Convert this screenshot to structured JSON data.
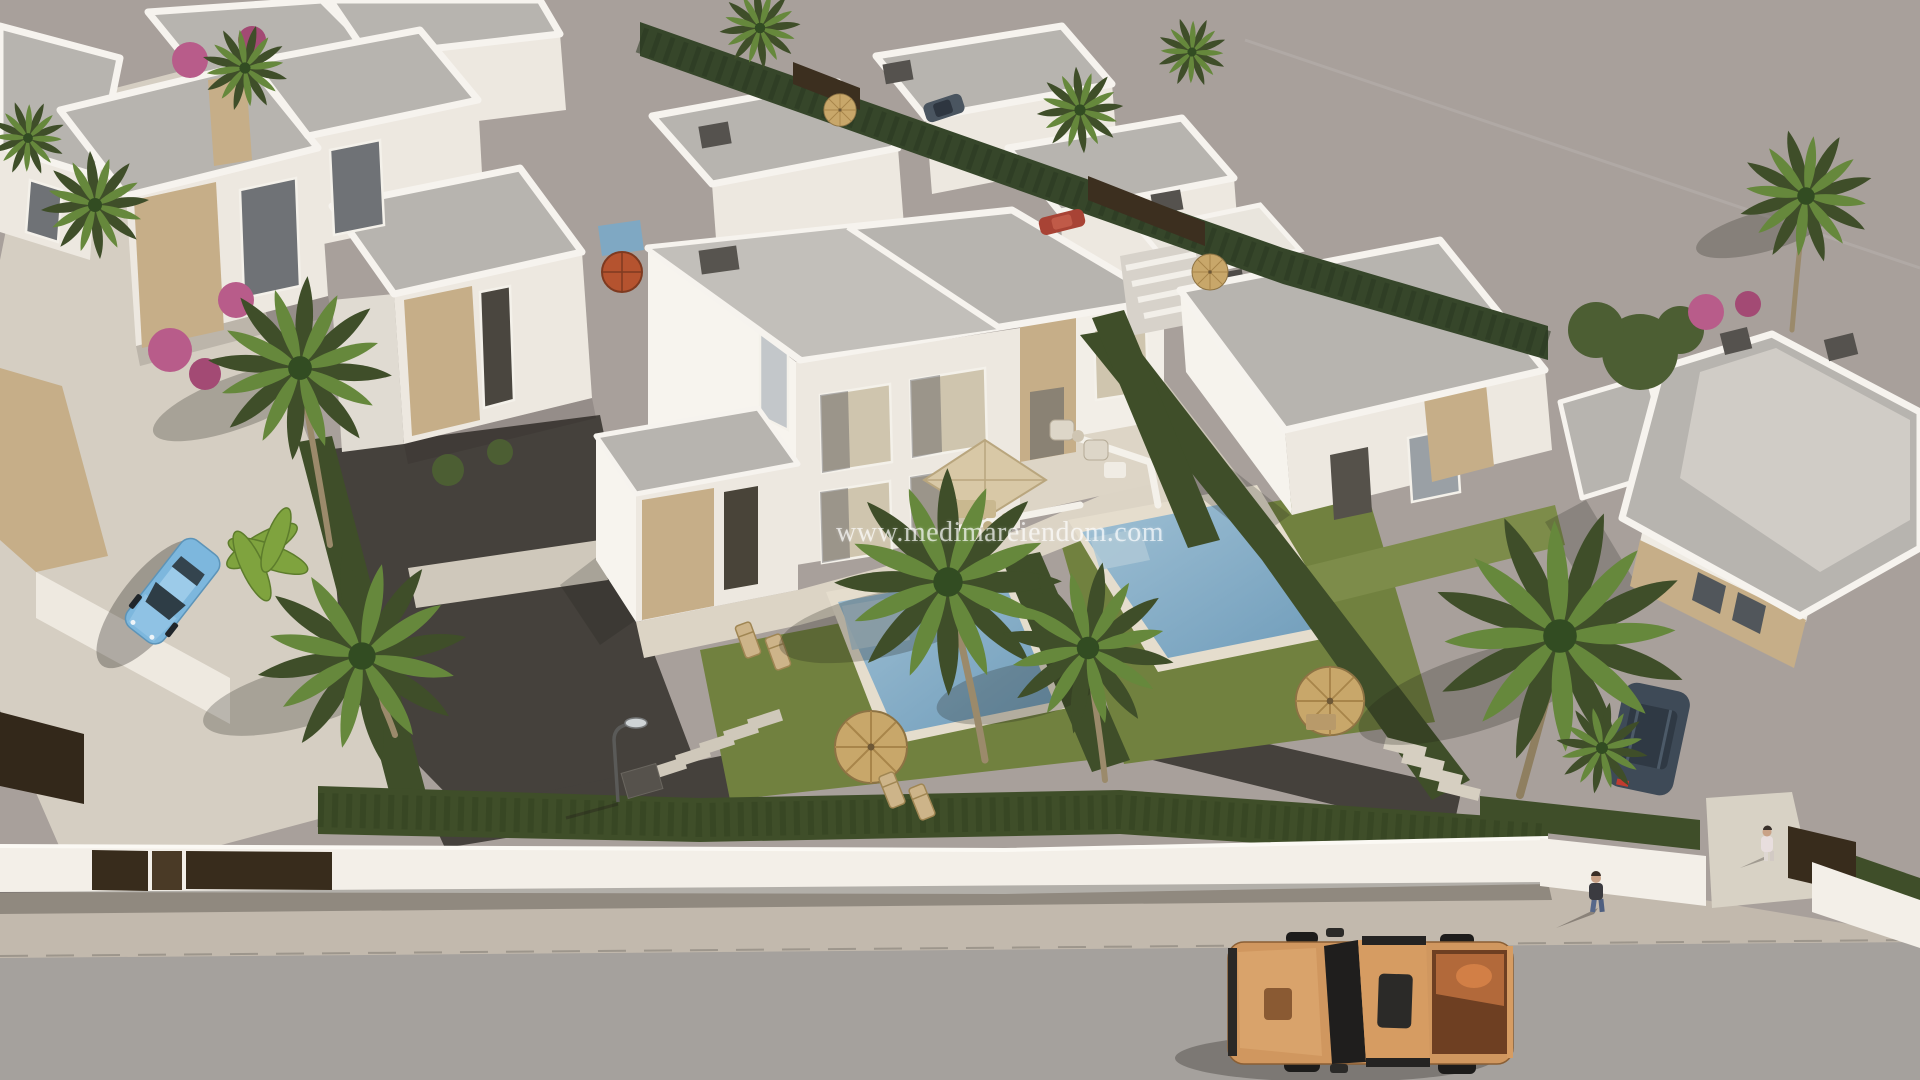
{
  "page": {
    "title": "Aerial 3D architectural render of a modern villa development"
  },
  "watermark": {
    "text": "www.medimareiendom.com"
  },
  "scene": {
    "description": "Photorealistic aerial 3D visualization of a Mediterranean residential development: rows of white flat-roof villas with travertine stone accents, a central semi-detached villa plot with two private mosaic pools, lawns, dark gravel driveway, palm trees, cypress hedges and a white boundary wall with brown gates; a street with sidewalk runs along the bottom where an orange pickup truck is parked; a light-blue car is parked on a bright footpath at the left; two pedestrians near the bottom-right entrance; large empty asphalt area at the top right.",
    "lighting": "warm late-afternoon sun, shadows falling to the lower left",
    "objects": [
      "white villas",
      "semi-detached villa",
      "flat gray roofs",
      "stone-clad walls",
      "swimming pool",
      "pool coping",
      "lawn",
      "gravel driveway",
      "cypress hedge",
      "palm trees",
      "banana plant",
      "bougainvillea",
      "boundary wall",
      "driveway gate",
      "pedestrian gate",
      "garage door",
      "sidewalk",
      "road",
      "pickup truck",
      "parked car",
      "suv",
      "pedestrians",
      "street lamp",
      "straw parasols",
      "red parasol",
      "beige terrace parasol",
      "outdoor sofa set",
      "sun loungers",
      "stepping stones",
      "manhole cover",
      "watermark"
    ]
  },
  "vehicles": {
    "pickup_truck": {
      "type": "double-cab pickup",
      "color_name": "orange",
      "hex": "#d0975f"
    },
    "parked_car": {
      "type": "sedan",
      "color_name": "light blue",
      "hex": "#7db7dd"
    },
    "suv": {
      "type": "suv behind hedge",
      "color_name": "dark slate",
      "hex": "#3e4a57"
    },
    "small_car_top": {
      "type": "distant parked car",
      "color_name": "gray blue",
      "hex": "#4a5560"
    },
    "red_car": {
      "type": "distant parked car",
      "color_name": "red",
      "hex": "#a84335"
    }
  },
  "people": {
    "count": 2,
    "notes": "one walking on sidewalk in dark top and jeans, one in light clothes at villa entrance"
  },
  "colors": {
    "ground": "#a8a09b",
    "road": "#a5a19d",
    "sidewalk": "#c2b9ad",
    "pavement": "#d5cec2",
    "gravel": "#45413c",
    "lawn": "#71813f",
    "lawn_light": "#7d8c4a",
    "hedge": "#3f4e29",
    "cypress": "#36462a",
    "pool_light": "#9fc0d4",
    "pool_deep": "#6f9cba",
    "pool_coping": "#e5ddcd",
    "villa_face": "#ede8e0",
    "villa_bright": "#f7f4ee",
    "roof": "#b7b4af",
    "stone": "#c6ae88",
    "curtain": "#cfc5ae",
    "wall_white": "#f3efe8",
    "gate_brown": "#382c1c",
    "straw": "#c8a76a",
    "parasol_red": "#b5532f",
    "truck_orange": "#d0975f",
    "truck_bed": "#6e3f22",
    "car_blue": "#7db7dd",
    "suv_dark": "#3e4a57",
    "watermark_color": "rgba(255,255,255,0.68)"
  }
}
